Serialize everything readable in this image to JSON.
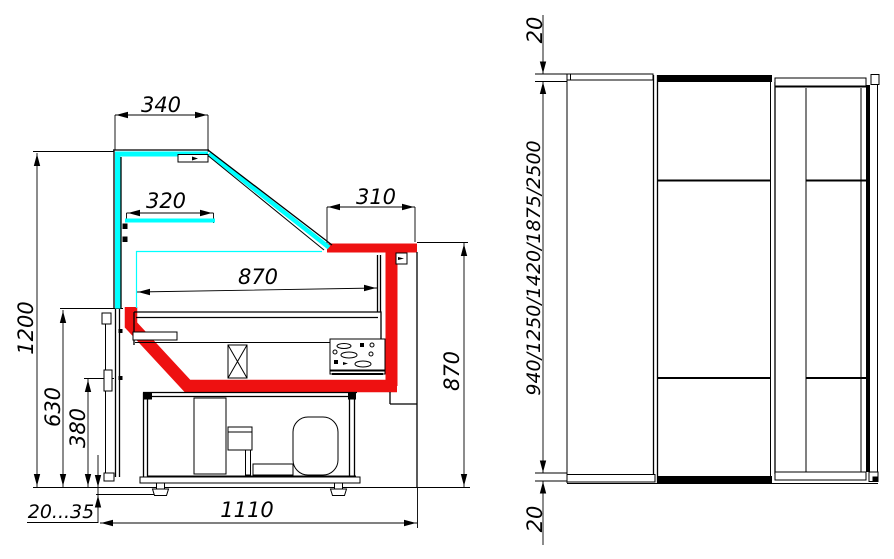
{
  "page": {
    "background": "#ffffff"
  },
  "colors": {
    "line": "#000000",
    "glass_cyan": "#00ffff",
    "highlight_red": "#ee1111"
  },
  "side_view": {
    "dimensions": {
      "canopy_width": "340",
      "shelf_width": "320",
      "rear_canopy_width": "310",
      "deck_width": "870",
      "rear_height": "870",
      "overall_height": "1200",
      "front_panel_height": "630",
      "lower_front_height": "380",
      "leg_adjustment": "20...35",
      "base_depth": "1110"
    }
  },
  "front_view": {
    "dimensions": {
      "top_panel_thickness": "20",
      "length_options": "940/1250/1420/1875/2500",
      "bottom_panel_thickness": "20"
    }
  }
}
